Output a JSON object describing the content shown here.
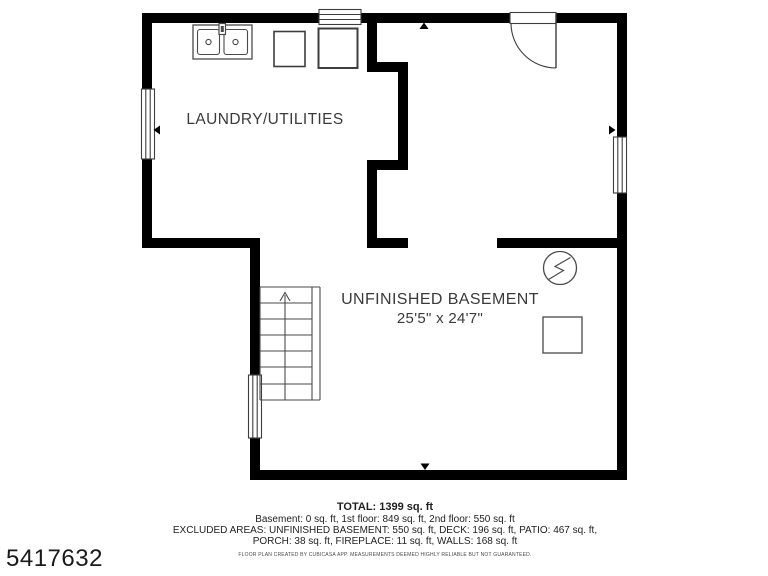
{
  "listing_id": "5417632",
  "rooms": {
    "laundry": {
      "label": "LAUNDRY/UTILITIES"
    },
    "basement": {
      "label": "UNFINISHED BASEMENT",
      "dimensions": "25'5\" x 24'7\""
    }
  },
  "fixtures": [
    "double-sink",
    "washer",
    "dryer",
    "staircase-up",
    "electrical-panel",
    "storage-box"
  ],
  "openings": [
    "entry-door-top-right",
    "window-top",
    "window-left",
    "window-right",
    "window-lower-left"
  ],
  "footer": {
    "total": "TOTAL: 1399 sq. ft",
    "floor_breakdown": "Basement: 0 sq. ft, 1st floor: 849 sq. ft, 2nd floor: 550 sq. ft",
    "excluded_areas_line1": "EXCLUDED AREAS: UNFINISHED BASEMENT: 550 sq. ft, DECK: 196 sq. ft, PATIO: 467 sq. ft,",
    "excluded_areas_line2": "PORCH: 38 sq. ft, FIREPLACE: 11 sq. ft, WALLS: 168 sq. ft",
    "disclaimer": "FLOOR PLAN CREATED BY CUBICASA APP. MEASUREMENTS DEEMED HIGHLY RELIABLE BUT NOT GUARANTEED."
  },
  "colors": {
    "wall": "#000000",
    "fixture_outline": "#4a4a4a",
    "room_label": "#3a3a3a",
    "footer_text": "#1f1f1f"
  }
}
